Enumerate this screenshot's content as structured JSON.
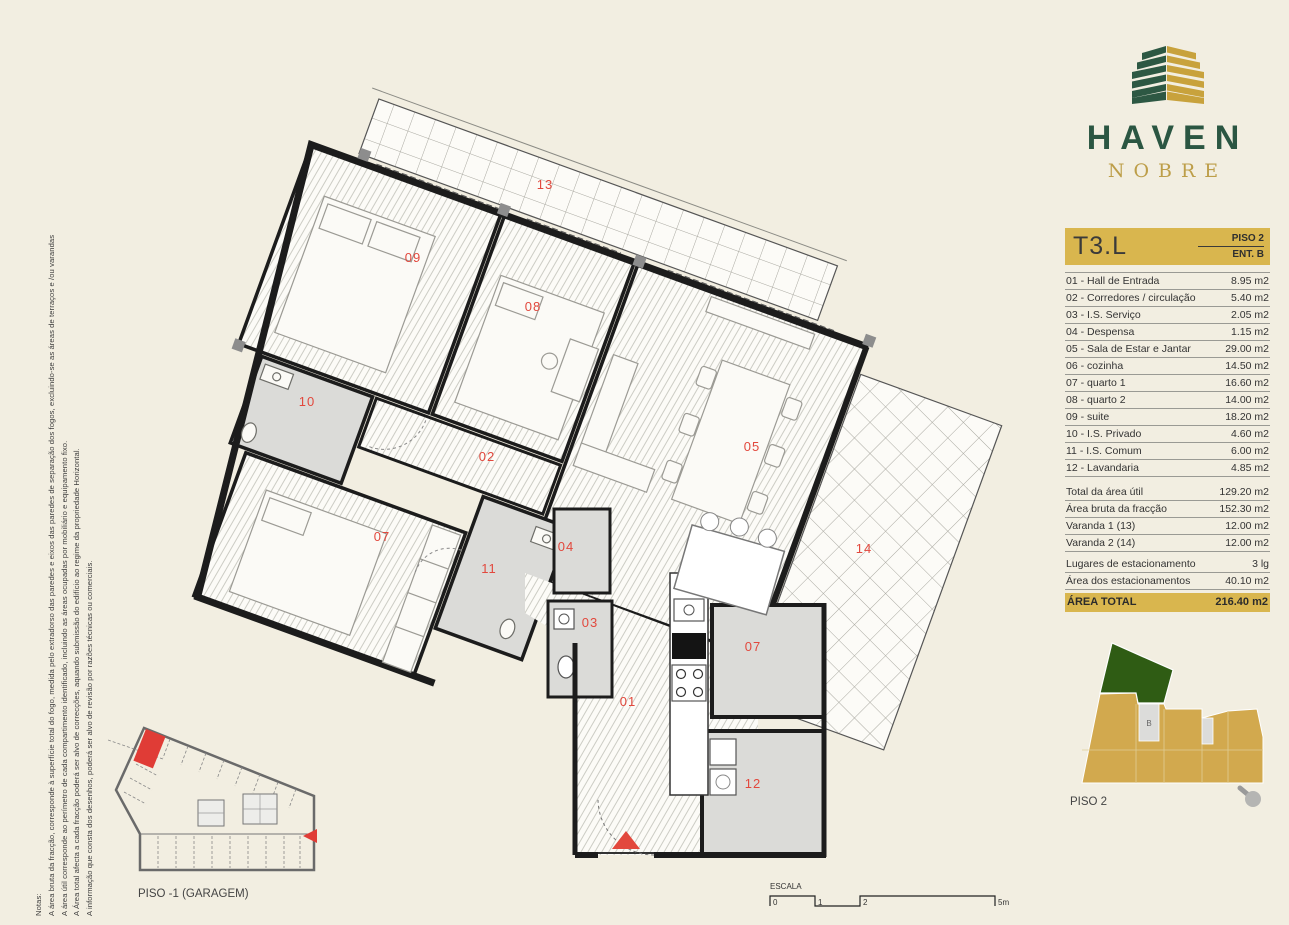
{
  "colors": {
    "bg": "#f2eee1",
    "gold": "#d9b64e",
    "logo_green": "#2d5843",
    "logo_gold": "#c8a23c",
    "red": "#e2483d",
    "gray_room": "#dbdbd8",
    "wall": "#1c1c1c",
    "site_gold": "#d2a94e",
    "site_green": "#2f5c14"
  },
  "notes": {
    "title": "Notas:",
    "lines": [
      "A área bruta da fracção, corresponde à superfície total do fogo, medida pelo extradorso das paredes e eixos das paredes de separação dos fogos, excluindo-se as áreas de terraços e /ou varandas",
      "A área útil corresponde ao perímetro de cada compartimento identificado, incluindo as áreas ocupadas por mobiliário e equipamento fixo.",
      "A Área total afecta a cada fracção poderá ser alvo de correcções, aquando submissão do edifício ao regime da propriedade Horizontal.",
      "A informação que consta dos desenhos, poderá ser alvo de revisão por razões técnicas ou comerciais."
    ]
  },
  "brand": {
    "name": "HAVEN",
    "subname": "NOBRE"
  },
  "unit": {
    "code": "T3.L",
    "floor": "PISO 2",
    "entrance": "ENT. B"
  },
  "rooms": [
    {
      "label": "01 - Hall de Entrada",
      "area": "8.95 m2"
    },
    {
      "label": "02 - Corredores / circulação",
      "area": "5.40 m2"
    },
    {
      "label": "03 - I.S. Serviço",
      "area": "2.05 m2"
    },
    {
      "label": "04 - Despensa",
      "area": "1.15 m2"
    },
    {
      "label": "05 - Sala de Estar e Jantar",
      "area": "29.00 m2"
    },
    {
      "label": "06 - cozinha",
      "area": "14.50 m2"
    },
    {
      "label": "07 - quarto 1",
      "area": "16.60 m2"
    },
    {
      "label": "08 - quarto 2",
      "area": "14.00 m2"
    },
    {
      "label": "09 - suite",
      "area": "18.20 m2"
    },
    {
      "label": "10 - I.S. Privado",
      "area": "4.60 m2"
    },
    {
      "label": "11 - I.S. Comum",
      "area": "6.00 m2"
    },
    {
      "label": "12 - Lavandaria",
      "area": "4.85 m2"
    }
  ],
  "totals": [
    {
      "label": "Total da área útil",
      "value": "129.20 m2"
    },
    {
      "label": "Área bruta da fracção",
      "value": "152.30 m2"
    },
    {
      "label": "Varanda 1 (13)",
      "value": "12.00 m2"
    },
    {
      "label": "Varanda 2 (14)",
      "value": "12.00 m2"
    },
    {
      "label": "Lugares de estacionamento",
      "value": "3 lg"
    },
    {
      "label": "Área dos estacionamentos",
      "value": "40.10 m2"
    }
  ],
  "grand_total": {
    "label": "ÁREA TOTAL",
    "value": "216.40 m2"
  },
  "plan": {
    "labels": [
      "13",
      "09",
      "08",
      "10",
      "02",
      "05",
      "07",
      "11",
      "04",
      "03",
      "01",
      "07",
      "12",
      "14"
    ]
  },
  "garage": {
    "caption": "PISO -1 (GARAGEM)"
  },
  "siteplan": {
    "caption": "PISO 2",
    "core_label": "B"
  },
  "scalebar": {
    "title": "ESCALA",
    "ticks": [
      "0",
      "1",
      "2",
      "5m"
    ]
  }
}
